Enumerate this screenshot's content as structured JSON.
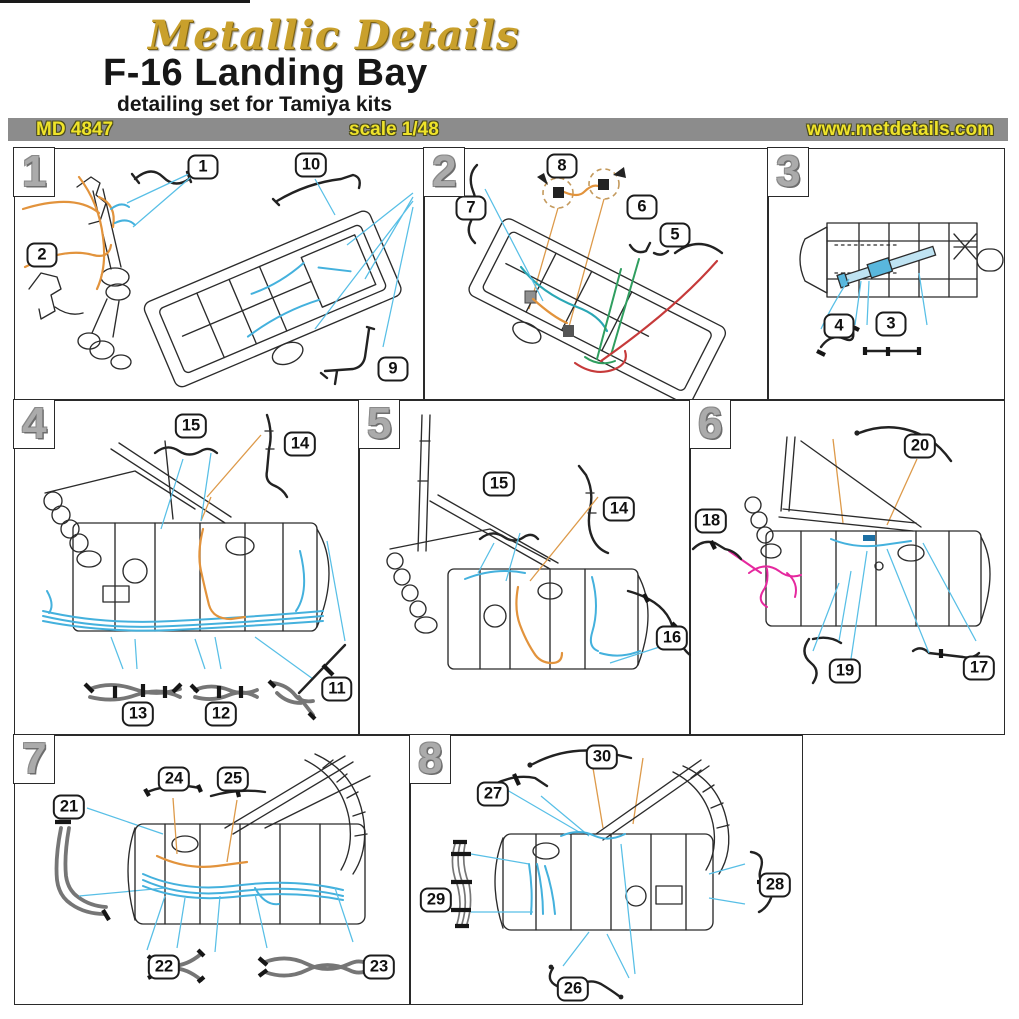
{
  "header": {
    "brand": "Metallic Details",
    "title": "F-16 Landing Bay",
    "subtitle": "detailing set for Tamiya kits",
    "product_code": "MD 4847",
    "scale": "scale 1/48",
    "website": "www.metdetails.com"
  },
  "palette": {
    "bar_background": "#8c8c8c",
    "accent_yellow": "#efe32a",
    "gold_brand": "#c9a02c",
    "wire_cyan": "#44b1dd",
    "wire_orange": "#e2933c",
    "wire_red": "#c63a3a",
    "wire_green": "#2f9e5f",
    "wire_teal": "#2aa7b5",
    "wire_magenta": "#e5289e",
    "line_black": "#2b2b2b",
    "part_gray": "#767676"
  },
  "panels": [
    {
      "number": "1",
      "callouts": [
        "1",
        "10",
        "2",
        "9"
      ]
    },
    {
      "number": "2",
      "callouts": [
        "8",
        "7",
        "6",
        "5"
      ]
    },
    {
      "number": "3",
      "callouts": [
        "4",
        "3"
      ]
    },
    {
      "number": "4",
      "callouts": [
        "15",
        "14",
        "11",
        "13",
        "12"
      ]
    },
    {
      "number": "5",
      "callouts": [
        "15",
        "14",
        "16"
      ]
    },
    {
      "number": "6",
      "callouts": [
        "20",
        "18",
        "19",
        "17"
      ]
    },
    {
      "number": "7",
      "callouts": [
        "24",
        "25",
        "21",
        "22",
        "23"
      ]
    },
    {
      "number": "8",
      "callouts": [
        "30",
        "27",
        "29",
        "28",
        "26"
      ]
    }
  ]
}
